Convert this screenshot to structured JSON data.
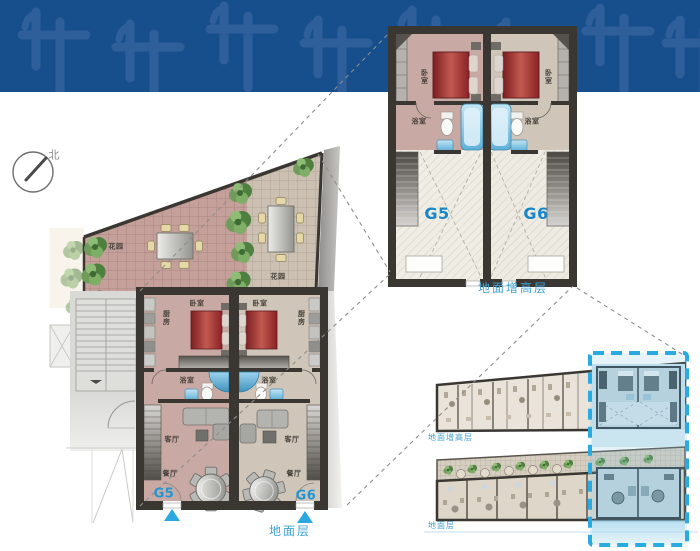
{
  "compass": {
    "north_label": "北"
  },
  "colors": {
    "band_bg": "#174f8c",
    "band_glyph": "#35649f",
    "caption_blue": "#3fa3d6",
    "unit_label_blue": "#1787c9",
    "entrance_triangle": "#29a9e0",
    "highlight_dash": "#29abe2",
    "bed_red": "#9e2b2e",
    "wall_dark": "#3a3733"
  },
  "ground_floor_plan": {
    "caption": "地面层",
    "units": {
      "left": "G5",
      "right": "G6"
    },
    "rooms": {
      "garden": "花园",
      "bedroom": "卧室",
      "kitchen": "厨房",
      "bathroom": "浴室",
      "living_room": "客厅",
      "dining_room": "餐厅"
    }
  },
  "raised_floor_plan": {
    "caption": "地面增高层",
    "units": {
      "left": "G5",
      "right": "G6"
    },
    "rooms": {
      "bedroom": "卧室",
      "bathroom": "浴室"
    }
  },
  "overview_plans": {
    "raised_caption": "地面增高层",
    "ground_caption": "地面层"
  }
}
